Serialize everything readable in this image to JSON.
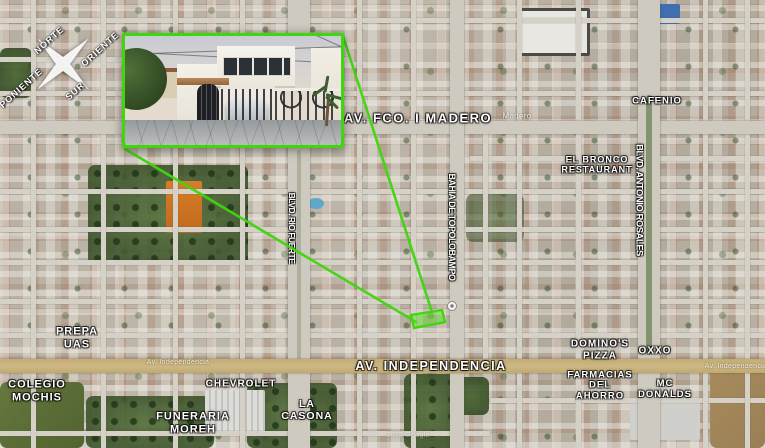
{
  "compass": {
    "north": "NORTE",
    "east": "ORIENTE",
    "west": "PONIENTE",
    "south": "SUR"
  },
  "streets": {
    "madero": "AV. FCO. I MADERO",
    "independencia": "AV. INDEPENDENCIA",
    "topolobampo": "BAHIA DE TOPOLOBAMPO",
    "rio_fuerte": "BLVD. RIO FUERTE",
    "rosales": "BLVD. ANTONIO ROSALES"
  },
  "faint_labels": {
    "madero_small": "Madero",
    "independencia_left": "Av. Independencia",
    "independencia_right": "Av. Independencia",
    "watermark": "2022 Google"
  },
  "pois": {
    "cafenio": {
      "l1": "CAFENIO"
    },
    "el_bronco": {
      "l1": "EL BRONCO",
      "l2": "RESTAURANT"
    },
    "prepa_uas": {
      "l1": "PREPA",
      "l2": "UAS"
    },
    "colegio_mochis": {
      "l1": "COLEGIO",
      "l2": "MOCHIS"
    },
    "chevrolet": {
      "l1": "CHEVROLET"
    },
    "la_casona": {
      "l1": "LA",
      "l2": "CASONA"
    },
    "funeraria_moreh": {
      "l1": "FUNERARIA",
      "l2": "MOREH"
    },
    "dominos": {
      "l1": "DOMINO'S",
      "l2": "PIZZA"
    },
    "oxxo": {
      "l1": "OXXO"
    },
    "farmacias": {
      "l1": "FARMACIAS",
      "l2": "DEL",
      "l3": "AHORRO"
    },
    "mcdonalds": {
      "l1": "MC",
      "l2": "DONALDS"
    }
  },
  "colors": {
    "highlight_green": "#3fd60e",
    "road_yellow": "#c9b273"
  }
}
